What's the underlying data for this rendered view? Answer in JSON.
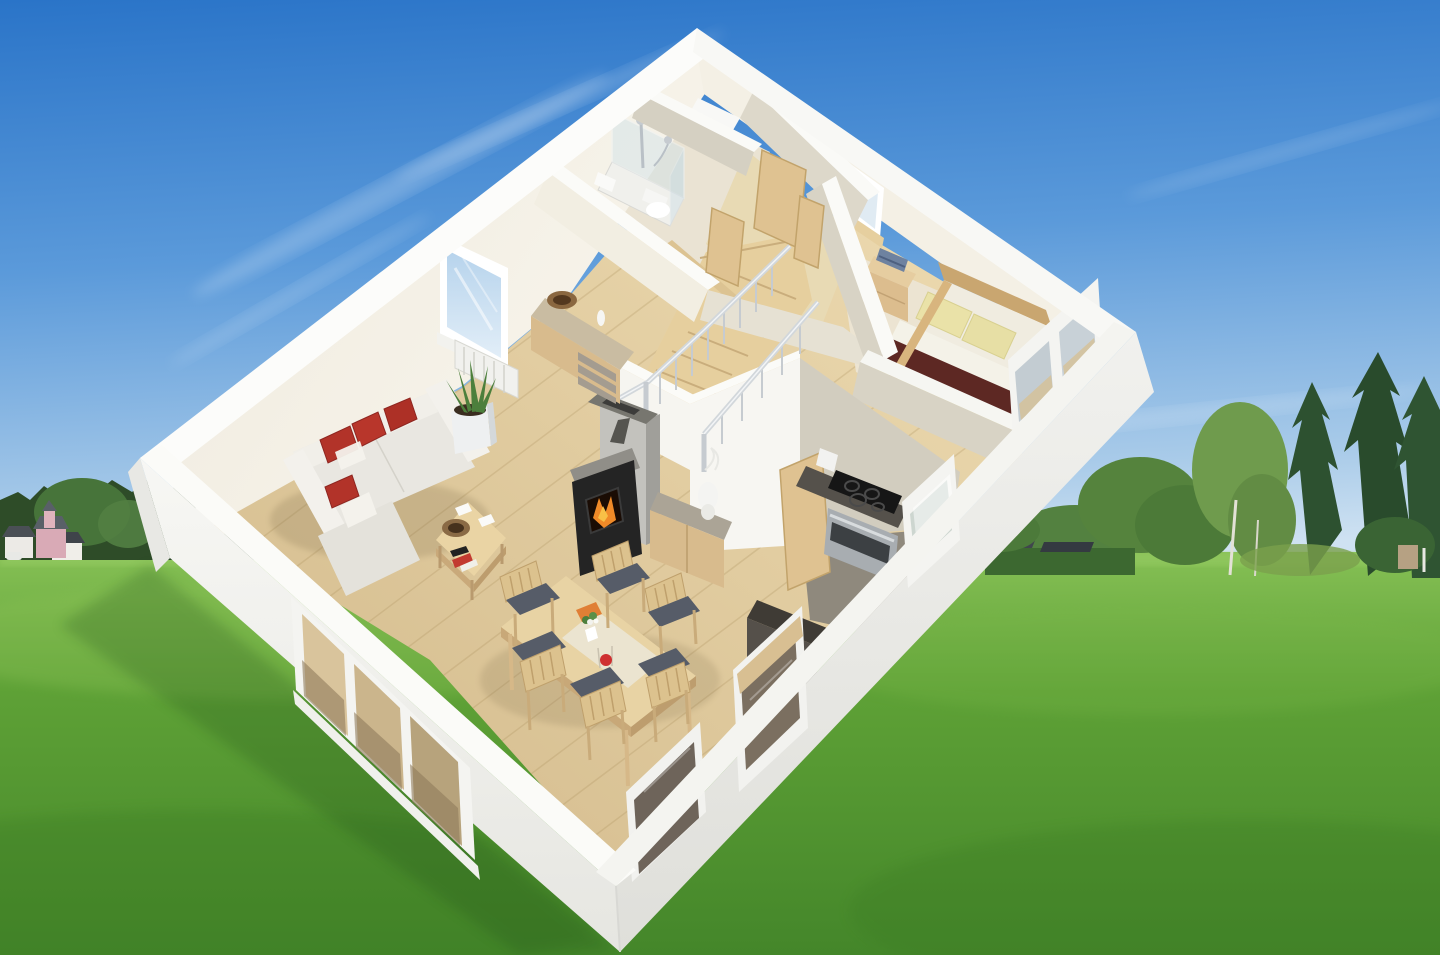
{
  "meta": {
    "title": "3D cutaway floor plan of a single-storey house on a green meadow",
    "alt": "Aerial 3D architectural rendering: a roofless white cutaway house model showing living room with red-cushioned sofa, wood stove, dining set, kitchen, bedroom, bathroom with shower, utility room and a winding staircase, composited onto a sunny green meadow with forest, village houses and tall trees on the horizon under a clear blue sky. No text is visible in the image."
  },
  "palette": {
    "sky_top": "#2a76ca",
    "sky_mid": "#5b9ada",
    "sky_horizon": "#cfe2f2",
    "cloud_white": "#ffffff",
    "grass_light": "#7cb94c",
    "grass_mid": "#5ea136",
    "grass_dark": "#478a27",
    "forest_dark": "#2e4c28",
    "tree_green": "#55833d",
    "birch_green": "#6f9b4d",
    "conifer_green": "#2d5130",
    "hedge_green": "#3c6830",
    "village_pink": "#d9aab6",
    "wall_white": "#f6f6f3",
    "wall_top": "#fbfbf9",
    "wall_cream": "#f5f1e6",
    "wall_shaded": "#d8d3c5",
    "floor_wood": "#e0c99c",
    "floor_pale": "#ece4d2",
    "floor_grey": "#8f897d",
    "door_wood": "#dfc291",
    "furniture_wood": "#d8bb8d",
    "sofa_fabric": "#e9e7e1",
    "cushion_red": "#b23329",
    "stove_black": "#242424",
    "fire_orange": "#f08a28",
    "chimney_grey": "#c3c2bd",
    "bedding_yellow": "#e7e0a2",
    "runner_maroon": "#5d2823",
    "counter_grey": "#55514b",
    "steel": "#a8adb1",
    "chrome": "#c6cbd0"
  },
  "scene": {
    "sky": "clear blue sky with faint wispy cloud streaks",
    "meadow": "bright green mown grass field",
    "left_horizon": [
      "dark conifer forest",
      "large deciduous trees",
      "village houses",
      "pink house with grey roof and turret",
      "white houses with dark roofs",
      "small white parked car"
    ],
    "right_horizon": [
      "trimmed garden hedge",
      "dark shed roofs behind hedge",
      "bushy deciduous trees",
      "birch trees with white trunks",
      "tall dark spruce trees",
      "small tan utility box"
    ],
    "house": {
      "style": "white cut-open walls, no roof, light oak plank flooring",
      "rooms": [
        {
          "name": "living-room",
          "contents": [
            "corner sofa with red cushions",
            "chaise with red cushion",
            "square coffee table with wooden bowl, cards and remote",
            "aloe plant in white pot",
            "sideboard with grey drawers and wooden bowl",
            "radiator below window",
            "wood-burning stove with visible fire",
            "grey stone chimney column",
            "low cabinet with white table lamp"
          ]
        },
        {
          "name": "dining-area",
          "contents": [
            "wooden dining table with cream runner",
            "orange book",
            "flower vase",
            "red fruit decoration",
            "six wooden chairs with dark blue-grey seat cushions"
          ]
        },
        {
          "name": "kitchen",
          "contents": [
            "black four-burner cooktop",
            "stainless steel oven",
            "dark grey countertop",
            "dark refrigerator cabinet",
            "white kettle",
            "open wooden door",
            "tilt-open window"
          ]
        },
        {
          "name": "hallway",
          "contents": [
            "open light-wood doors",
            "window with wooden sill"
          ]
        },
        {
          "name": "bedroom",
          "contents": [
            "double bed with pale yellow bedding",
            "dark red bed runner",
            "wooden headboard",
            "two pillows",
            "nightstand with blue books",
            "small wooden bench"
          ]
        },
        {
          "name": "bathroom",
          "contents": [
            "glass shower cabin with chrome fittings",
            "white toilet",
            "small washbasin"
          ]
        },
        {
          "name": "utility-room",
          "contents": [
            "white washing machine"
          ]
        },
        {
          "name": "staircase",
          "contents": [
            "wooden winder stairs",
            "chrome railing with balusters",
            "wooden handrail"
          ]
        }
      ],
      "windows": [
        "living room window over radiator",
        "hallway window",
        "two slanted bedroom windows",
        "kitchen window",
        "dining room window",
        "corner window",
        "wide three-pane glazed patio unit"
      ]
    }
  }
}
